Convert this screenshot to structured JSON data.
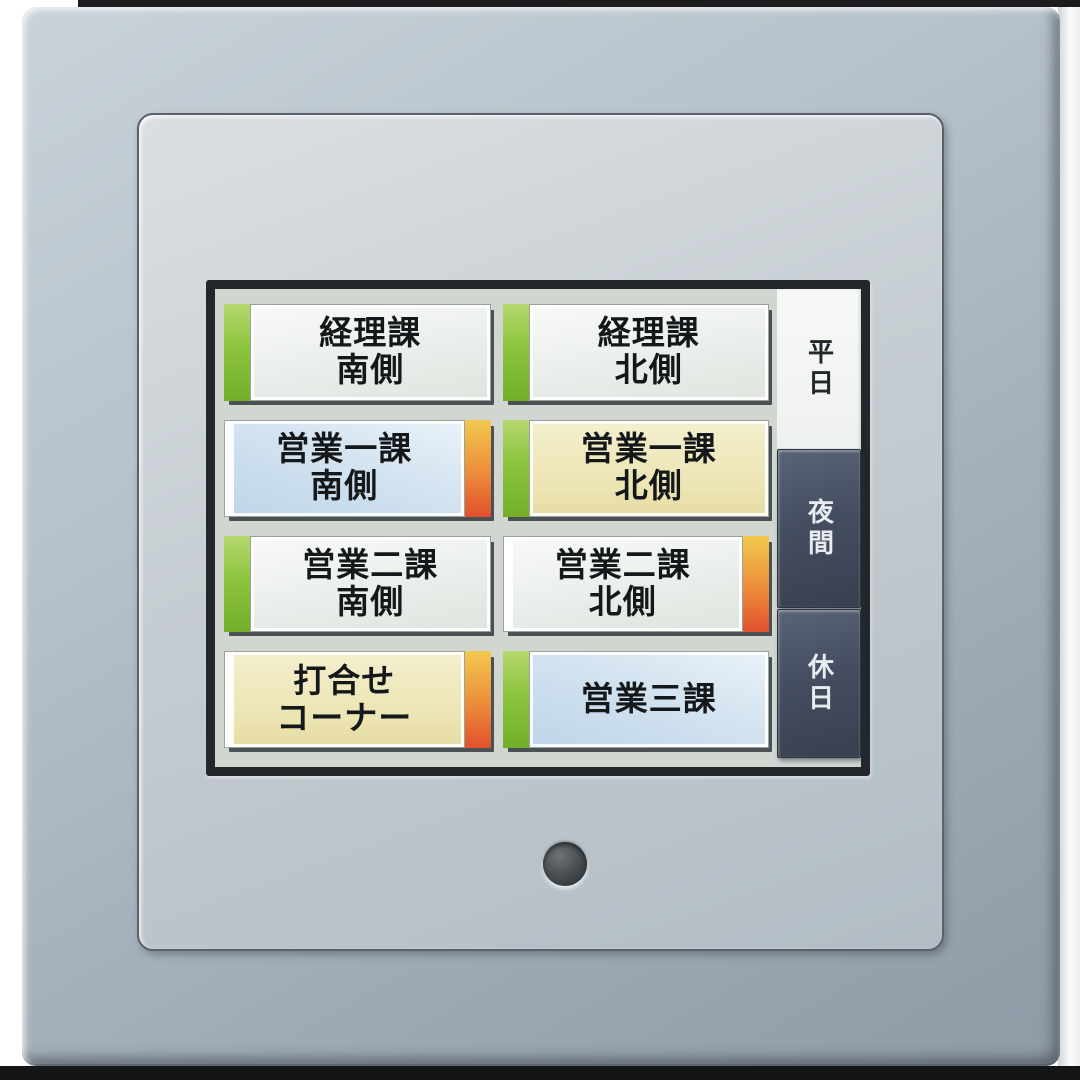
{
  "panel": {
    "description": "wall-mounted touch panel lighting scene controller",
    "frame_color": "#aab6c0",
    "plate_color": "#c6cdd2",
    "bezel_color": "#23272b",
    "screen_bg": "#d2d6d1",
    "service_button_color": "#3a4044"
  },
  "screen": {
    "buttons": [
      {
        "id": "keirika-minami",
        "label": "経理課 南側",
        "lines": [
          "経理課",
          "南側"
        ],
        "face_color_name": "white",
        "face_hex": "#eff2ef",
        "stripe_color_name": "green",
        "stripe_hex": "#8cc43e",
        "stripe_side": "left"
      },
      {
        "id": "keirika-kita",
        "label": "経理課 北側",
        "lines": [
          "経理課",
          "北側"
        ],
        "face_color_name": "white",
        "face_hex": "#eff2ef",
        "stripe_color_name": "green",
        "stripe_hex": "#8cc43e",
        "stripe_side": "left"
      },
      {
        "id": "eigyo-1ka-minami",
        "label": "営業一課 南側",
        "lines": [
          "営業一課",
          "南側"
        ],
        "face_color_name": "light-blue",
        "face_hex": "#cfe0ee",
        "stripe_color_name": "orange-red",
        "stripe_hex": "#ec8c3a",
        "stripe_side": "right"
      },
      {
        "id": "eigyo-1ka-kita",
        "label": "営業一課 北側",
        "lines": [
          "営業一課",
          "北側"
        ],
        "face_color_name": "pale-yellow",
        "face_hex": "#ece4b2",
        "stripe_color_name": "green",
        "stripe_hex": "#8cc43e",
        "stripe_side": "left"
      },
      {
        "id": "eigyo-2ka-minami",
        "label": "営業二課 南側",
        "lines": [
          "営業二課",
          "南側"
        ],
        "face_color_name": "white",
        "face_hex": "#eff2ef",
        "stripe_color_name": "green",
        "stripe_hex": "#8cc43e",
        "stripe_side": "left"
      },
      {
        "id": "eigyo-2ka-kita",
        "label": "営業二課 北側",
        "lines": [
          "営業二課",
          "北側"
        ],
        "face_color_name": "white",
        "face_hex": "#eff2ef",
        "stripe_color_name": "orange-red",
        "stripe_hex": "#ec8c3a",
        "stripe_side": "right"
      },
      {
        "id": "uchiawase-corner",
        "label": "打合せ コーナー",
        "lines": [
          "打合せ",
          "コーナー"
        ],
        "face_color_name": "pale-yellow",
        "face_hex": "#ece4b2",
        "stripe_color_name": "orange-red",
        "stripe_hex": "#ec8c3a",
        "stripe_side": "right"
      },
      {
        "id": "eigyo-3ka",
        "label": "営業三課",
        "lines": [
          "営業三課"
        ],
        "face_color_name": "light-blue",
        "face_hex": "#d6e6f2",
        "stripe_color_name": "green",
        "stripe_hex": "#8cc43e",
        "stripe_side": "left"
      }
    ],
    "tabs": [
      {
        "id": "weekday",
        "label": "平日",
        "selected": true,
        "bg_hex": "#f5f7f5",
        "text_hex": "#23262a"
      },
      {
        "id": "night",
        "label": "夜間",
        "selected": false,
        "bg_hex": "#454e60",
        "text_hex": "#e8ebf0"
      },
      {
        "id": "holiday",
        "label": "休日",
        "selected": false,
        "bg_hex": "#454e60",
        "text_hex": "#e8ebf0"
      }
    ]
  }
}
